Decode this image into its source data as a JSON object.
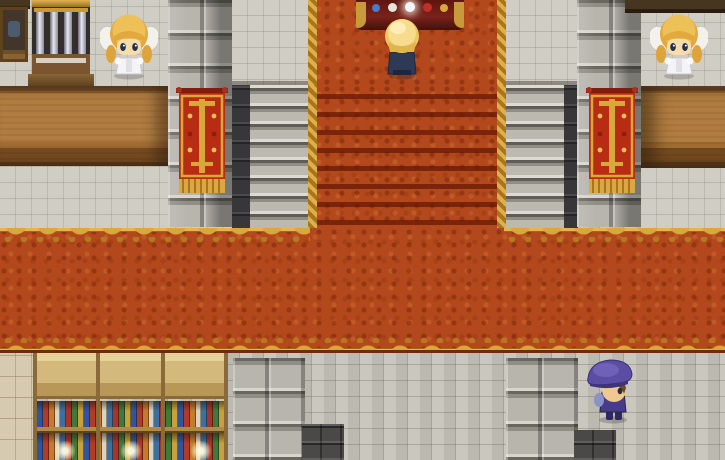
{
  "scene": {
    "type": "top-down RPG interior (game screenshot)",
    "location_label": "Grand cathedral hall with central carpeted staircase",
    "visible_text": "none"
  },
  "palette": {
    "carpet_orange": "#b2481c",
    "carpet_step_shadow": "#7a1e08",
    "gold_trim": "#d9a83c",
    "stone_floor": "#c6c3b9",
    "stone_block": "#b6b3ab",
    "dark_rail": "#38383a",
    "counter_wood": "#b07c40",
    "banner_red": "#b82c14",
    "bookshelf_wood": "#d3ba7c",
    "player_hat_purple": "#5b4da4"
  },
  "entities": {
    "left_priestess": {
      "label": "Winged priestess NPC at left counter",
      "hair": "blonde",
      "outfit": "white robe, white wings"
    },
    "right_priestess": {
      "label": "Winged priestess NPC at right counter",
      "hair": "blonde",
      "outfit": "white robe, white wings"
    },
    "altar_acolyte": {
      "label": "Blonde acolyte standing at the altar",
      "outfit": "navy robe",
      "facing": "up"
    },
    "player": {
      "label": "Player character with purple beret",
      "facing": "right"
    },
    "altar": {
      "label": "Altar table with offerings"
    },
    "pipe_organ": {
      "label": "Pipe organ"
    },
    "left_cabinet": {
      "label": "Wooden cabinet with vessel"
    },
    "left_counter": {
      "label": "Wooden service counter (left)"
    },
    "right_counter": {
      "label": "Wooden service counter (right)"
    },
    "left_banner": {
      "label": "Red and gold banner on left pillar"
    },
    "right_banner": {
      "label": "Red and gold banner on right pillar"
    },
    "staircase": {
      "label": "Carpeted grand staircase with stone side steps"
    },
    "hall_carpet": {
      "label": "Ornate red hall carpet with gold scalloped border"
    },
    "bookshelves": {
      "label": "Bookshelves filled with colored books",
      "count": 3
    },
    "left_pillar": {
      "label": "Stone pillar (left)"
    },
    "right_pillar": {
      "label": "Stone pillar (right)"
    },
    "stair_base_left": {
      "label": "Stone block base below left stair wall"
    },
    "stair_base_right": {
      "label": "Stone block base below right stair wall"
    },
    "down_steps_left": {
      "label": "Dark descending steps (bottom left of hall)"
    },
    "down_steps_right": {
      "label": "Dark descending steps (bottom right of hall)"
    }
  }
}
